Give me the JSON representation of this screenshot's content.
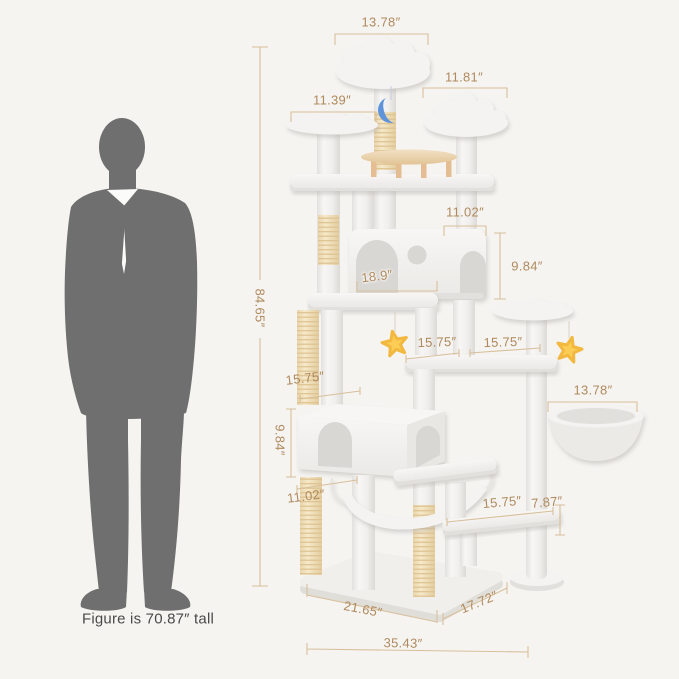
{
  "figure": {
    "caption": "Figure is 70.87″  tall",
    "description": "gray-human-silhouette"
  },
  "dims": {
    "top_cloud_width": "13.78″",
    "right_cloud_width": "11.81″",
    "left_perch_width": "11.39″",
    "total_height": "84.65″",
    "condo_top_width": "11.02″",
    "condo_height": "9.84″",
    "condo_inner_width": "18.9″",
    "mid_left_width": "15.75″",
    "mid_right_width": "15.75″",
    "lower_condo_width": "15.75″",
    "lower_condo_height": "9.84″",
    "lower_condo_base_width": "11.02″",
    "basket_width": "13.78″",
    "bottom_platform_width": "15.75″",
    "bottom_right_height": "7.87″",
    "base_side_left": "21.65″",
    "base_side_right": "17.72″",
    "base_total_width": "35.43″"
  },
  "toys": {
    "moon": "crescent-moon-plush",
    "star_left": "star-plush",
    "star_right": "star-plush"
  },
  "colors": {
    "background": "#f5f4f1",
    "dim_text": "#b08a5e",
    "dim_line": "#d8bf9b",
    "figure": "#6f6f6f",
    "caption_text": "#4a4a4a",
    "plush_white": "#f4f3f1",
    "plush_shadow": "#e2e0dc",
    "opening": "#d9d7d3",
    "sisal": "#f1e2c0",
    "sisal_line": "#ddc18f",
    "wood_light": "#eed9ba",
    "wood_peg": "#e5bd92",
    "moon": "#5f93da",
    "star": "#fbcd55"
  }
}
